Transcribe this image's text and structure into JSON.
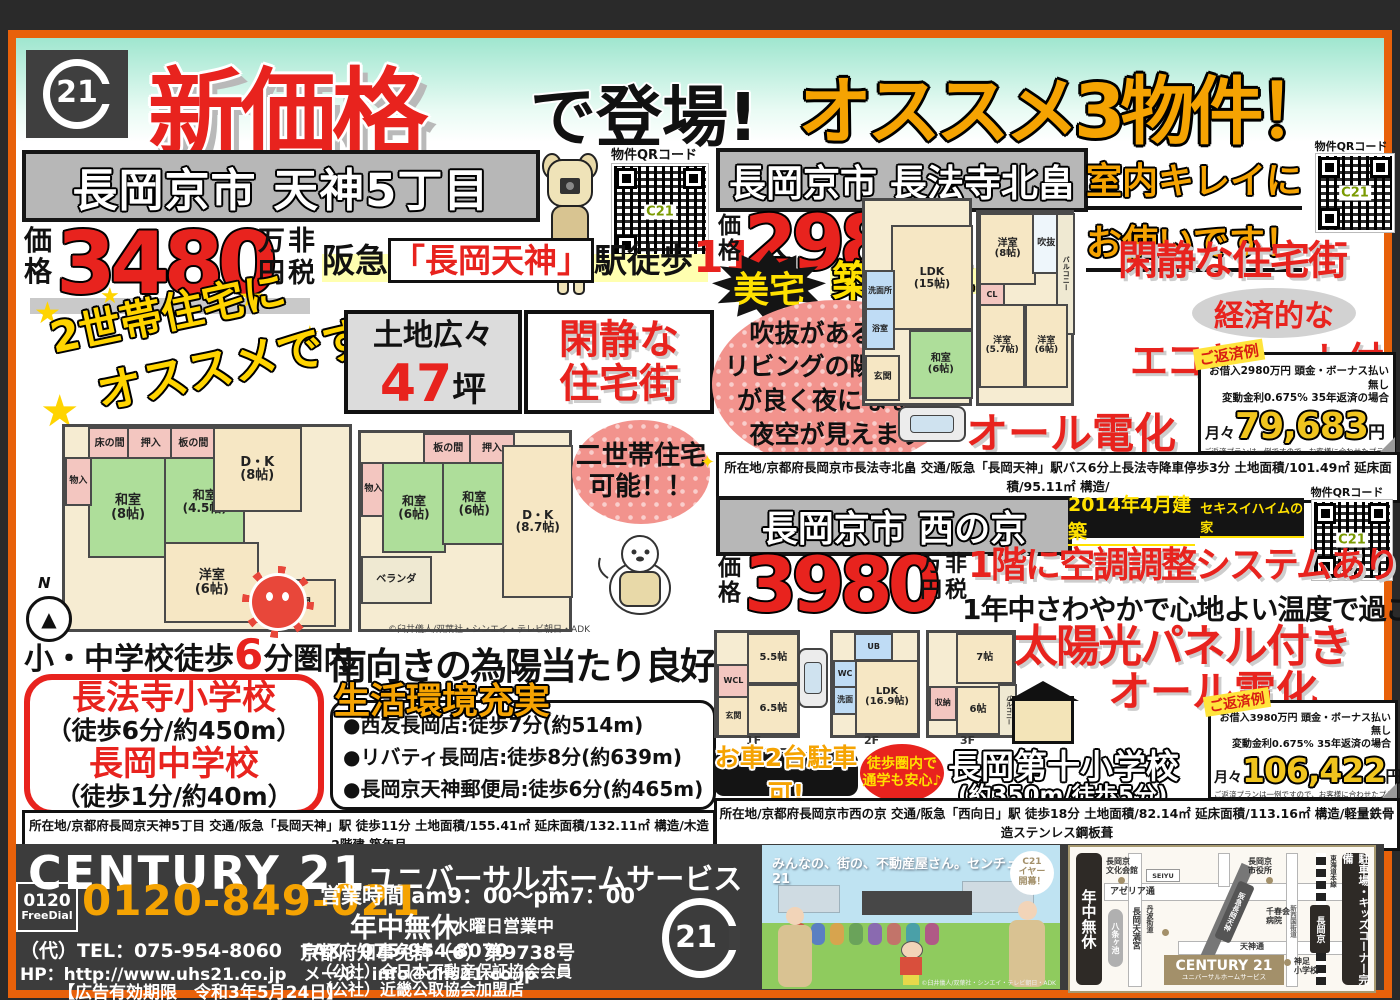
{
  "header": {
    "logo": "21",
    "new_price": "新価格",
    "debut": "で登場!",
    "recommend": "オススメ3物件！"
  },
  "qr": {
    "label": "物件QRコード",
    "center": "C21"
  },
  "icons": {
    "star": "★",
    "sparkle": "✦",
    "compass_n": "N",
    "compass_arrow": "▲",
    "torii": "开"
  },
  "price_common": {
    "label_a": "価",
    "label_b": "格",
    "u1": "万",
    "u2": "非",
    "u3": "円",
    "u4": "税"
  },
  "p1": {
    "title": "長岡京市 天神5丁目",
    "price": "3480",
    "access_pre": "阪急",
    "access_station": "「長岡天神」",
    "access_mid": "駅徒歩",
    "access_min": "11",
    "access_suf": "分",
    "catch1": "2世帯住宅に",
    "catch2": "オススメです!",
    "land1": "土地広々",
    "land_num": "47",
    "land_unit": "坪",
    "quiet": "閑静な\n住宅街",
    "dual": "二世帯住宅\n可能！！",
    "walk_pre": "小・中学校徒歩",
    "walk_num": "6",
    "walk_suf": "分圏内",
    "school1": "長法寺小学校",
    "school1_d": "（徒歩6分/約450m）",
    "school2": "長岡中学校",
    "school2_d": "（徒歩1分/約40m）",
    "south": "南向きの為陽当たり良好",
    "life_title": "生活環境充実",
    "life1": "●西友長岡店:徒歩7分(約514m)",
    "life2": "●リバティ長岡店:徒歩8分(約639m)",
    "life3": "●長岡京天神郵便局:徒歩6分(約465m)",
    "details1": "所在地/京都府長岡京天神5丁目 交通/阪急「長岡天神」駅 徒歩11分 土地面積/155.41㎡ 延床面積/132.11㎡ 構造/木造2階建 築年月",
    "details2": "/1962年4月 現況/居住中 引渡し/相談 取引態様／仲介",
    "copyright": "©臼井儀人/双葉社・シンエイ・テレビ朝日・ADK",
    "plan1_rooms": [
      "床の間",
      "押入",
      "板の間",
      "和室\n(8帖)",
      "和室\n(4.5帖)",
      "D・K\n(8帖)",
      "洋室\n(6帖)",
      "物入",
      "玄関"
    ],
    "plan2_rooms": [
      "板の間",
      "押入",
      "物入",
      "和室\n(6帖)",
      "和室\n(6帖)",
      "D・K\n(8.7帖)",
      "ベランダ"
    ]
  },
  "p2": {
    "title": "長岡京市 長法寺北畠",
    "clean1": "室内キレイに",
    "clean2": "お使いです！",
    "price": "2980",
    "bitaku": "美宅",
    "chiku": "築18年",
    "void1": "吹抜がある為、",
    "void2": "リビングの陽当たり",
    "void3": "が良く夜になると",
    "void4": "夜空が見えます",
    "quiet": "閑静な住宅街",
    "eco1": "経済的な",
    "eco2": "エコキュート付",
    "alldenka": "オール電化",
    "pay_title": "ご返済例",
    "pay_l1": "お借入2980万円 頭金・ボーナス払い無し",
    "pay_l2": "変動金利0.675%  35年返済の場合",
    "pay_pre": "月々",
    "pay_amount": "79,683",
    "pay_yen": "円",
    "pay_note1": "ご返済プランは一例ですので、お客様に合わせたプランの",
    "pay_note2": "ご提案も可能ですので、当社営業までお問合せ下さい。",
    "details1": "所在地/京都府長岡京市長法寺北畠 交通/阪急「長岡天神」駅バス6分上長法寺降車停歩3分 土地面積/101.49㎡ 延床面積/95.11㎡ 構造/",
    "details2": "木造2階建 築年月/2003年4月 現況/居住中 引渡し/相談 取引態様／仲介",
    "plan1_rooms": [
      "LDK\n(15帖)",
      "洗面所",
      "浴室",
      "和室\n(6帖)",
      "玄関"
    ],
    "plan2_rooms": [
      "洋室\n(8帖)",
      "吹抜",
      "バルコニー",
      "CL",
      "洋室\n(5.7帖)",
      "洋室\n(6帖)"
    ]
  },
  "p3": {
    "title": "長岡京市 西の京",
    "built": "2014年4月建築",
    "maker": "セキスイハイムの家",
    "price": "3980",
    "aircon": "1階に空調調整システムあり",
    "comfort": "1年中さわやかで心地よい温度で過ごせます",
    "solar": "太陽光パネル付き",
    "alldenka": "オール電化",
    "car": "お車2台駐車可!",
    "walkzone": "徒歩圏内で\n通学も安心♪",
    "school": "長岡第十小学校",
    "school_d": "(約350m/徒歩5分)",
    "pay_title": "ご返済例",
    "pay_l1": "お借入3980万円 頭金・ボーナス払い無し",
    "pay_l2": "変動金利0.675%  35年返済の場合",
    "pay_pre": "月々",
    "pay_amount": "106,422",
    "pay_yen": "円",
    "pay_note1": "ご返済プランは一例ですので、お客様に合わせたプランの",
    "pay_note2": "ご提案も可能ですので、当社営業までお問合せ下さい。",
    "details1": "所在地/京都府長岡京市西の京 交通/阪急「西向日」駅 徒歩18分 土地面積/82.14㎡ 延床面積/113.16㎡ 構造/軽量鉄骨造ステンレス鋼板葺",
    "details2": "3階建 築年月/2014年4月 現況/居住中 引渡し/要相談 取引態様／仲介",
    "plan1_rooms": [
      "玄関",
      "WCL",
      "5.5帖",
      "6.5帖"
    ],
    "plan2_rooms": [
      "UB",
      "WC",
      "洗面",
      "LDK\n(16.9帖)"
    ],
    "plan3_rooms": [
      "7帖",
      "6帖",
      "収納",
      "バルコニー"
    ],
    "floors": [
      "1F",
      "2F",
      "3F"
    ]
  },
  "footer": {
    "brand": "CENTURY 21",
    "company": "ユニバーサルホームサービス",
    "freedial_num": "0120",
    "freedial": "FreeDial",
    "phone": "0120-849-021",
    "hours": "営業時間 am9：00～pm7：00",
    "open": "年中無休",
    "wed": "水曜日営業中",
    "telfax": "（代）TEL：075-954-8060　FAX：075-954-8070",
    "license": "京都府知事免許（6）第9738号",
    "web": "HP：http://www.uhs21.co.jp　メール：info@uhs21.co.jp",
    "assoc1": "（公社）全日本不動産保証協会会員",
    "assoc2": "（公社）近畿公取協会加盟店",
    "expiry": "【広告有効期限　令和3年5月24日】",
    "c21": "21",
    "promo_text": "みんなの、街の、不動産屋さん。センチュリー21",
    "promo_badge": "C21\nイヤー\n開幕！",
    "promo_copyright": "©臼井儀人/双葉社・シンエイ・テレビ朝日・ADK"
  },
  "map": {
    "left_bar": "年中無休",
    "right_bar": "駐車場・キッズコーナー完備",
    "azeria": "アゼリア通",
    "tenjin_st": "天神通",
    "bunka": "長岡京\n文化会館",
    "seiyu": "SEIYU",
    "cityhall": "長岡京\n市役所",
    "pond": "八条ヶ池",
    "tenmangu": "長岡天満宮",
    "hankyu": "阪急長岡天神",
    "hospital": "千春会\n病院",
    "shinsaigoku": "新西国街道",
    "tanba": "丹波街道",
    "jr_station": "長岡京",
    "tokaido": "東海道本線",
    "school": "神足\n小学校",
    "shop": "CENTURY 21",
    "shop_sub": "ユニバーサルホームサービス"
  }
}
